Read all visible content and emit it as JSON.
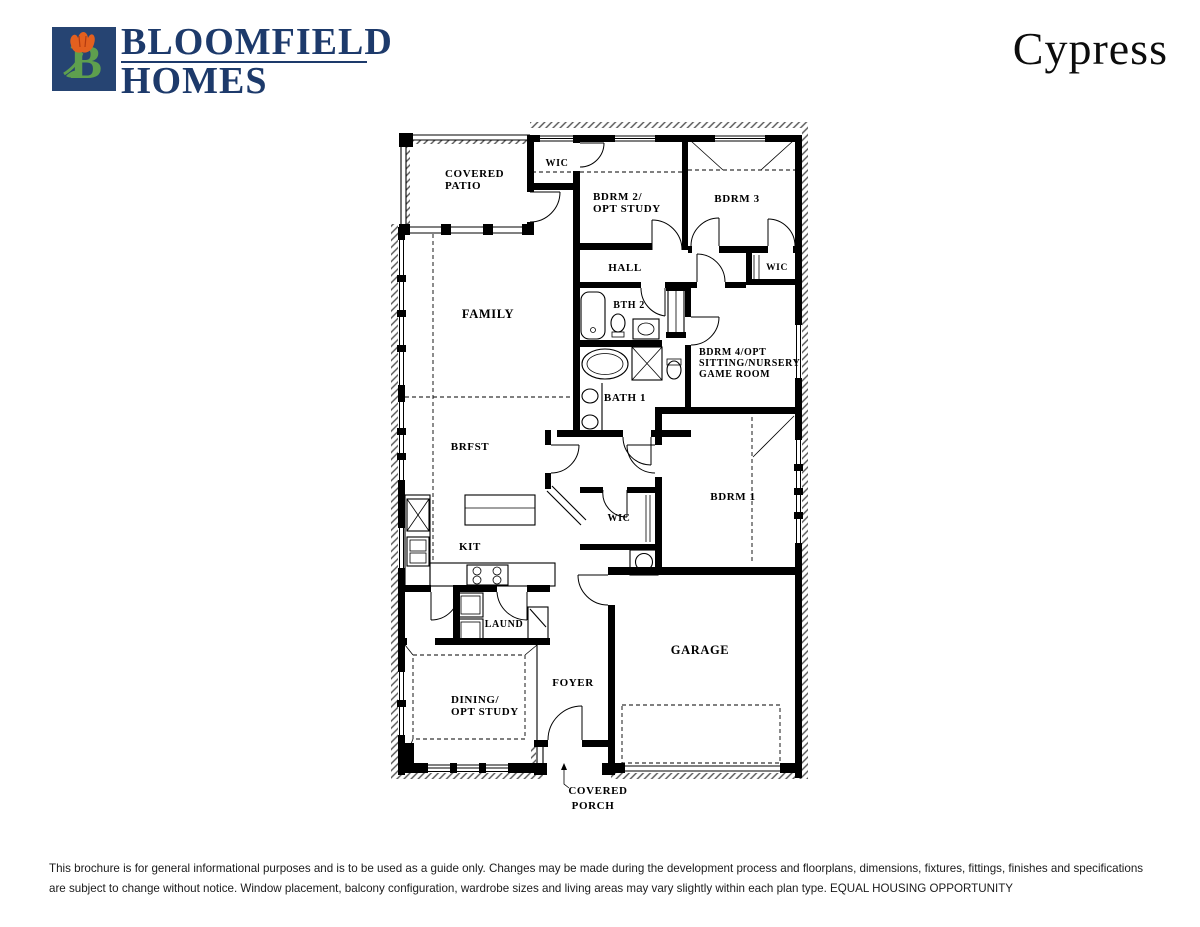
{
  "header": {
    "logo": {
      "letter": "B",
      "square_color": "#264472",
      "letter_color": "#5e9f4e",
      "tulip_color": "#e3601f"
    },
    "brand_line1": "BLOOMFIELD",
    "brand_line2": "HOMES",
    "plan_name": "Cypress"
  },
  "floorplan": {
    "rooms": {
      "covered_patio": [
        "COVERED",
        "PATIO"
      ],
      "wic_bdrm2": "WIC",
      "bdrm2": [
        "BDRM 2/",
        "OPT STUDY"
      ],
      "bdrm3": "BDRM 3",
      "hall": "HALL",
      "wic_bdrm3": "WIC",
      "bth2": "BTH 2",
      "family": "FAMILY",
      "bdrm4": [
        "BDRM 4/OPT",
        "SITTING/NURSERY",
        "GAME ROOM"
      ],
      "bath1": "BATH 1",
      "brfst": "BRFST",
      "bdrm1": "BDRM 1",
      "wic_bdrm1": "WIC",
      "kit": "KIT",
      "laund": "LAUND",
      "garage": "GARAGE",
      "foyer": "FOYER",
      "dining": [
        "DINING/",
        "OPT STUDY"
      ],
      "covered_porch": [
        "COVERED",
        "PORCH"
      ]
    }
  },
  "footer": {
    "disclaimer": "This brochure is for general informational purposes and is to be used as a guide only. Changes may be made during the development process and floorplans, dimensions, fixtures, fittings, finishes and specifications are subject to change without notice. Window placement, balcony configuration, wardrobe sizes and living areas may vary slightly within each plan type.  EQUAL HOUSING OPPORTUNITY"
  }
}
